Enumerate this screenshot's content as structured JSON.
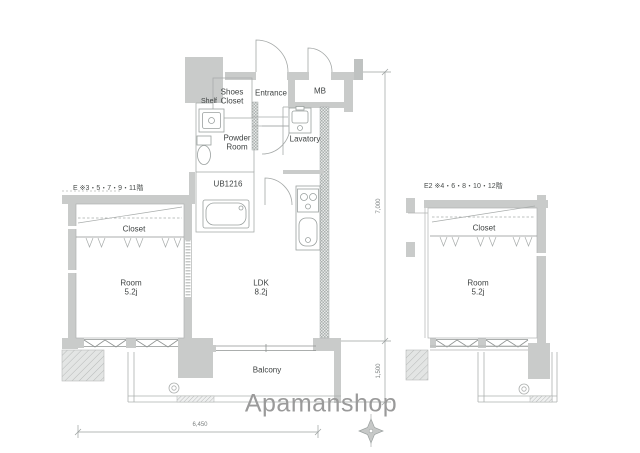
{
  "floorplan": {
    "watermark": "Apamanshop",
    "units": {
      "left_note": "E ※3・5・7・9・11階",
      "right_note": "E2 ※4・6・8・10・12階"
    },
    "labels": {
      "shoes_closet_1": "Shoes",
      "shoes_closet_2": "Closet",
      "entrance": "Entrance",
      "mb": "MB",
      "shelf": "Shelf",
      "powder_room_1": "Powder",
      "powder_room_2": "Room",
      "lavatory": "Lavatory",
      "unit_bath": "UB1216",
      "closet_left": "Closet",
      "closet_right": "Closet",
      "room_left_1": "Room",
      "room_left_2": "5.2j",
      "room_right_1": "Room",
      "room_right_2": "5.2j",
      "ldk_1": "LDK",
      "ldk_2": "8.2j",
      "balcony": "Balcony"
    },
    "dimensions": {
      "total_height": "7,000",
      "balcony_depth": "1,500",
      "total_width": "6,450"
    },
    "colors": {
      "wall": "#c9cbca",
      "line": "#9aa09f",
      "text": "#3f4343",
      "watermark": "#9a9a9a"
    }
  }
}
